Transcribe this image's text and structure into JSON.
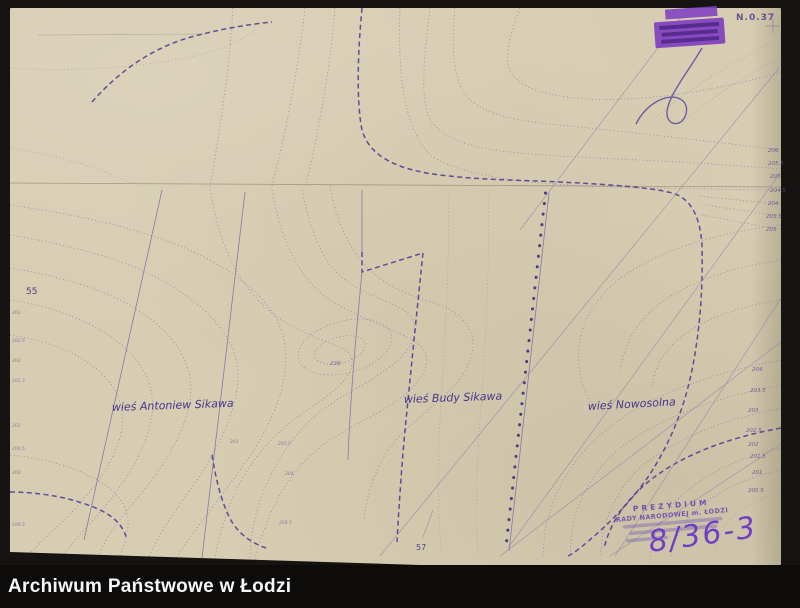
{
  "archive_bar": {
    "label": "Archiwum Państwowe w Łodzi"
  },
  "map": {
    "sheet_number": "N.0.37",
    "labels": {
      "village_left": "wieś Antoniew Sikawa",
      "village_middle": "wieś Budy Sikawa",
      "village_right": "wieś Nowosolna",
      "parcel_left": "55",
      "parcel_bottom": "57",
      "hill": "230"
    },
    "stamp_bottom": {
      "line1": "PREZYDIUM",
      "line2": "RADY NARODOWEJ m. ŁODZI"
    },
    "handwritten_ref": "8/36-3",
    "contour_labels_right_edge": [
      "206",
      "205.5",
      "205",
      "204.5",
      "204",
      "203.5",
      "203"
    ],
    "contour_labels_fan": [
      "204",
      "203.5",
      "203",
      "202.5",
      "202",
      "201.5",
      "201",
      "200.5"
    ],
    "contour_labels_left_edge": [
      "203",
      "202.5",
      "202",
      "201.5",
      "201",
      "200.5",
      "200",
      "199.5"
    ],
    "contour_labels_inline": [
      "203",
      "203.5",
      "204",
      "204.5"
    ],
    "colors": {
      "paper": "#d7cdb2",
      "ink": "#5b4a9c",
      "contour": "#8379ae",
      "heavy_contour": "#4d3b92",
      "stamp": "#8040c0",
      "handwriting": "#6f3ec6",
      "background": "#161412",
      "bar_text": "#f7f7f7"
    }
  }
}
